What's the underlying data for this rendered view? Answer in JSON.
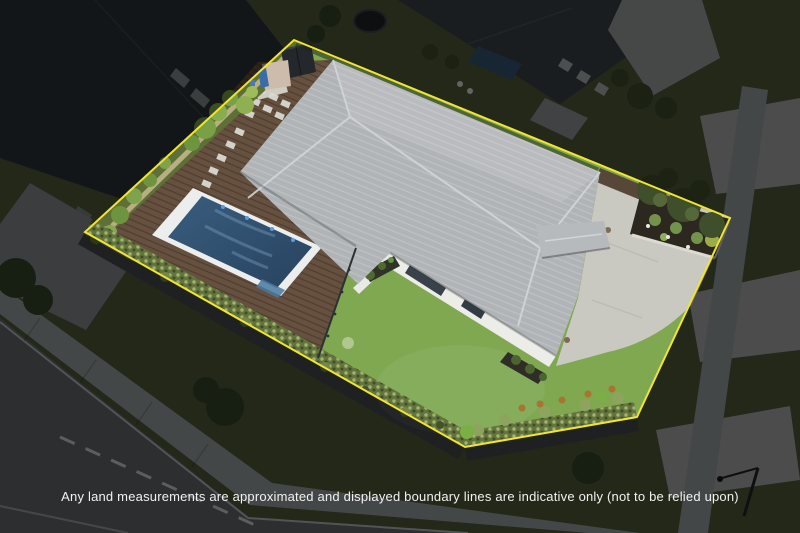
{
  "image": {
    "width": 800,
    "height": 533,
    "kind": "aerial-drone-photo",
    "subject": "residential property with highlighted lot boundary"
  },
  "disclaimer": {
    "text": "Any land measurements are approximated and displayed boundary lines are indicative only (not to be relied upon)"
  },
  "boundary": {
    "points": "294,40 730,218 637,417 465,447 85,232",
    "stroke": "#f2e434",
    "overlay_path": "M0 0 H800 V533 H0 Z M294 40 L730 218 L637 417 L465 447 L85 232 Z",
    "overlay_fill": "rgba(0,0,0,0.55)"
  },
  "features": [
    "main house with grey metal hip roof",
    "rectangular swimming pool",
    "timber pool deck",
    "lawn",
    "concrete driveway",
    "garden shed",
    "boundary hedge",
    "raised garden bed",
    "palm garden",
    "neighbouring houses",
    "street with dashed centre line",
    "footpath"
  ],
  "colors": {
    "lawn": "#7fa851",
    "deck": "#66503f",
    "roof": "#b1b4b7",
    "roof_ridge": "#d2d5d8",
    "pool_coping": "#eceeee",
    "pool_water_deep": "#27435f",
    "pool_water_light": "#3a5d7e",
    "driveway": "#c9c9c1",
    "hedge": "#64743f",
    "mulch": "#2c2820",
    "house_wall": "#ecede9",
    "shed": "#24282c",
    "pale_fence": "#c9b98f",
    "outside_grass": "#4e5a38",
    "street_asphalt": "#63676b",
    "footpath": "#989da1",
    "neighbor_roof_left": "#2c3135",
    "neighbor_roof_right": "#3a4045",
    "boundary_yellow": "#f2e434"
  }
}
